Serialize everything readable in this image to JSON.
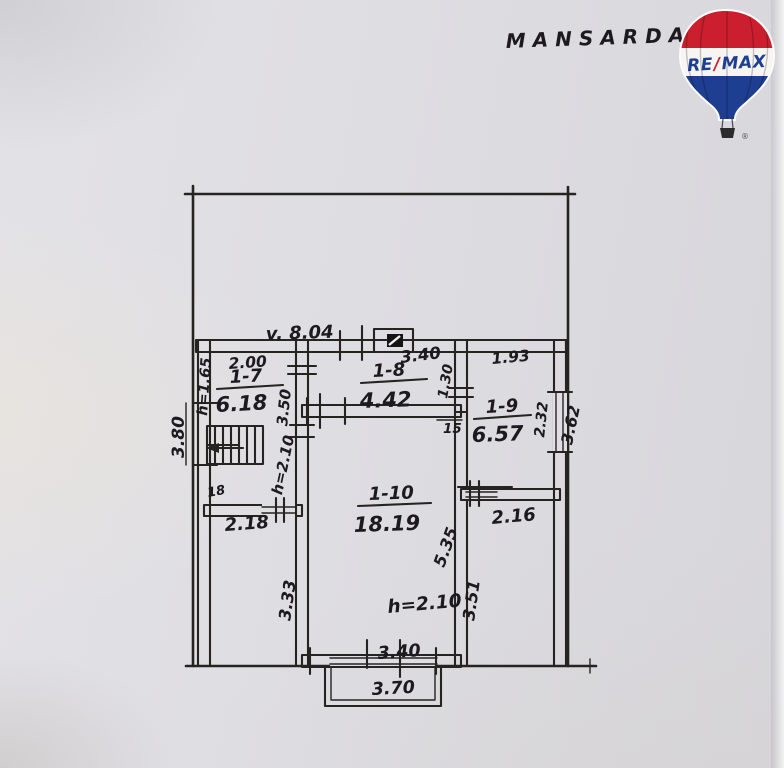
{
  "title": "MANSARDA",
  "logo": {
    "re": "RE",
    "slash": "/",
    "max": "MAX",
    "registered": "®",
    "colors": {
      "red": "#cb1f2f",
      "blue": "#1e3e92",
      "white": "#f7f5f1"
    }
  },
  "plan": {
    "ink_color": "#262420",
    "wall_fill_color": "#efe7d2",
    "paper_color": "#dfdee2",
    "rooms": [
      {
        "id": "1-7",
        "area": "6.18"
      },
      {
        "id": "1-8",
        "area": "4.42"
      },
      {
        "id": "1-9",
        "area": "6.57"
      },
      {
        "id": "1-10",
        "area": "18.19"
      }
    ],
    "dims": {
      "overall_width": "v. 8.04",
      "r7_width": "2.00",
      "r7_height_note": "h=1.65",
      "left_side": "3.80",
      "stair_steps": "18",
      "r7_bottom": "2.18",
      "r7_right": "3.50",
      "hall_height_note": "h=2.10",
      "r8_width": "3.40",
      "r8_right": "1.30",
      "wall_thickness": "15",
      "r9_top": "1.93",
      "r9_window": "2.32",
      "r9_right_outside": "3.62",
      "r9_bottom": "2.16",
      "r10_right_inside": "5.35",
      "r10_right_outside": "3.51",
      "r10_left": "3.33",
      "r10_height_note": "h=2.10",
      "r10_bottom": "3.40",
      "balcony_width": "3.70"
    }
  }
}
